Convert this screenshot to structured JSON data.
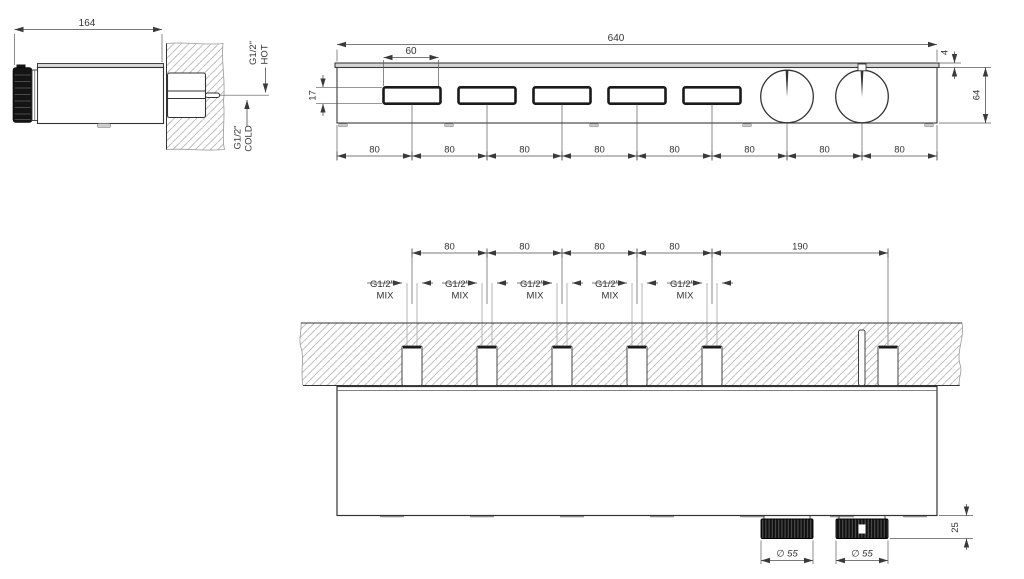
{
  "drawing": {
    "side_view": {
      "length_dim": "164",
      "hot_port": {
        "size": "G1/2\"",
        "label": "HOT"
      },
      "cold_port": {
        "size": "G1/2\"",
        "label": "COLD"
      }
    },
    "front_view": {
      "overall_width_dim": "640",
      "button_width_dim": "60",
      "button_height_dim": "17",
      "trim_thickness_dim": "4",
      "height_dim": "64",
      "spacing_dims": [
        "80",
        "80",
        "80",
        "80",
        "80",
        "80",
        "80",
        "80"
      ]
    },
    "plan_view": {
      "spacing_dims": [
        "80",
        "80",
        "80",
        "80"
      ],
      "end_offset_dim": "190",
      "mix_ports": [
        {
          "size": "G1/2\"",
          "label": "MIX"
        },
        {
          "size": "G1/2\"",
          "label": "MIX"
        },
        {
          "size": "G1/2\"",
          "label": "MIX"
        },
        {
          "size": "G1/2\"",
          "label": "MIX"
        },
        {
          "size": "G1/2\"",
          "label": "MIX"
        }
      ],
      "knob_dia_dims": [
        "∅ 55",
        "∅ 55"
      ],
      "knob_depth_dim": "25"
    }
  }
}
